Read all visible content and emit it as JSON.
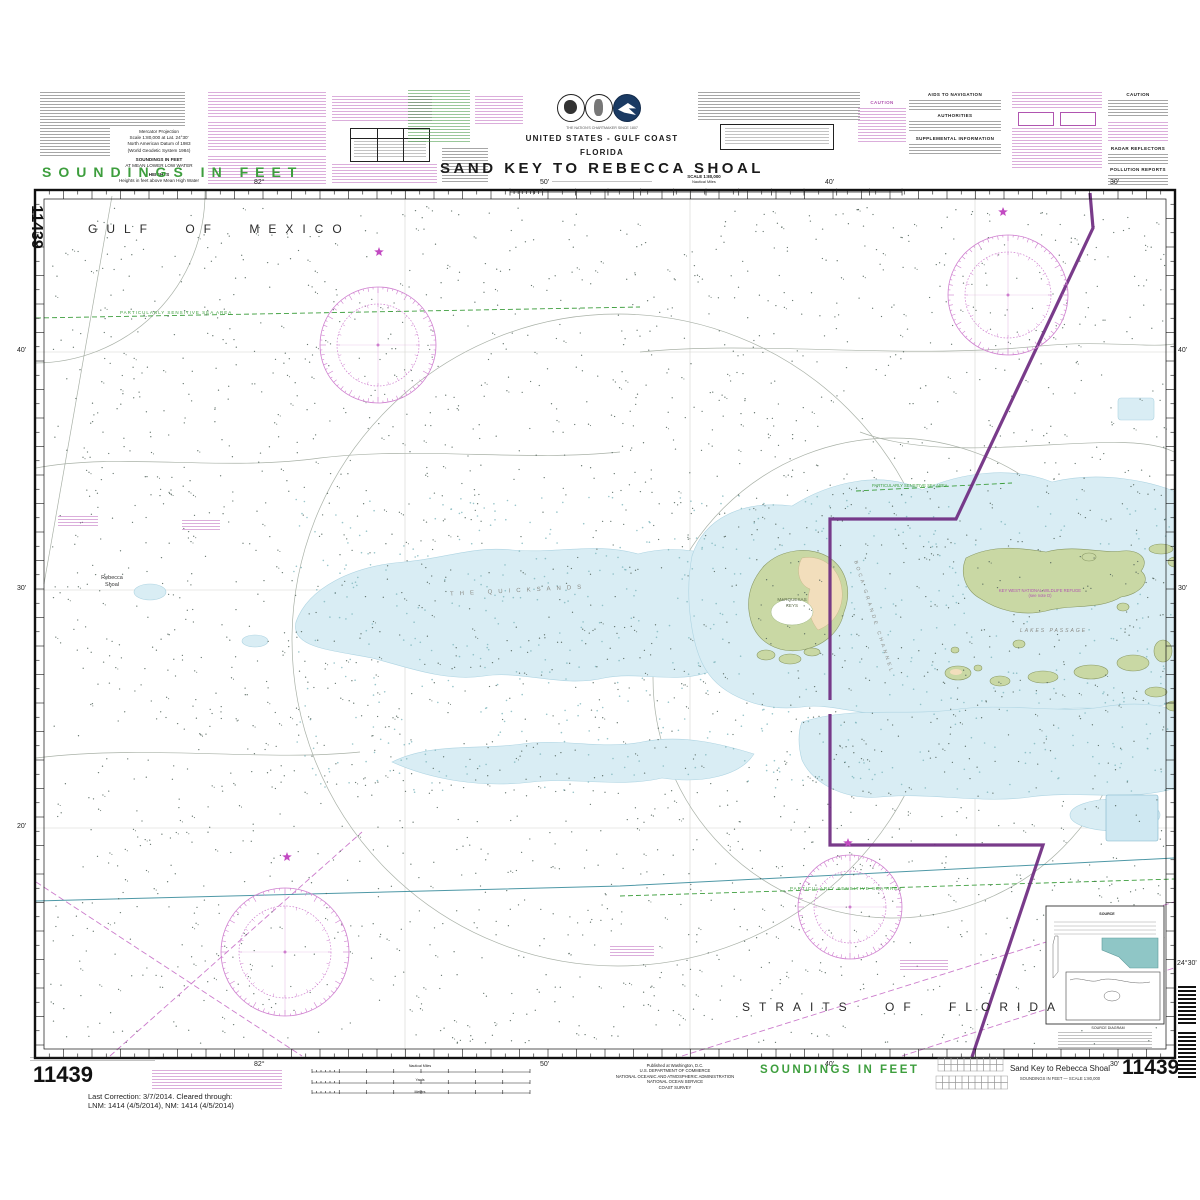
{
  "header": {
    "tagline": "THE NATION'S CHARTMAKER SINCE 1807",
    "region": "UNITED STATES - GULF COAST",
    "state": "FLORIDA",
    "title": "SAND KEY TO REBECCA SHOAL",
    "scale_label": "SCALE 1:80,000",
    "scale_units": "Nautical Miles"
  },
  "projection": {
    "lines": [
      "Mercator Projection",
      "Scale 1:80,000 at Lat. 24°30'",
      "North American Datum of 1983",
      "(World Geodetic System 1984)",
      "SOUNDINGS IN FEET",
      "AT MEAN LOWER LOW WATER",
      "HEIGHTS",
      "Heights in feet above Mean High Water"
    ]
  },
  "notes": {
    "caution": "CAUTION",
    "aids_to_navigation": "AIDS TO NAVIGATION",
    "authorities": "AUTHORITIES",
    "supplemental_information": "SUPPLEMENTAL INFORMATION",
    "radar_reflectors": "RADAR REFLECTORS",
    "pollution_reports": "POLLUTION REPORTS"
  },
  "margin": {
    "soundings_top": "SOUNDINGS IN FEET",
    "soundings_bottom": "SOUNDINGS IN FEET",
    "chart_number": "11439",
    "last_correction_line1": "Last Correction: 3/7/2014.  Cleared through:",
    "last_correction_line2": "LNM: 1414 (4/5/2014), NM: 1414 (4/5/2014)",
    "publisher": [
      "Published at Washington, D.C.",
      "U.S. DEPARTMENT OF COMMERCE",
      "NATIONAL OCEANIC AND ATMOSPHERIC ADMINISTRATION",
      "NATIONAL OCEAN SERVICE",
      "COAST SURVEY"
    ],
    "caption_title": "Sand Key to Rebecca Shoal",
    "caption_sub": "SOUNDINGS IN FEET — SCALE 1:80,000",
    "scalebar_miles": "Nautical Miles",
    "scalebar_yards": "Yards",
    "scalebar_meters": "Meters"
  },
  "map": {
    "sea1": "GULF OF MEXICO",
    "sea2": "STRAITS OF FLORIDA",
    "labels": {
      "rebecca1": "Rebecca",
      "rebecca2": "Shoal",
      "quicksands": "THE QUICKSANDS",
      "boca_grande": "BOCA GRANDE CHANNEL",
      "marquesas1": "MARQUESAS",
      "marquesas2": "KEYS",
      "lakes_passage": "LAKES   PASSAGE",
      "refuge1": "KEY WEST NATIONAL WILDLIFE REFUGE",
      "refuge2": "(see note D)",
      "pssa": "PARTICULARLY SENSITIVE SEA AREA"
    },
    "graticule": {
      "top": [
        "82°",
        "50'",
        "40'",
        "30'"
      ],
      "bottom": [
        "82°",
        "50'",
        "40'",
        "30'"
      ],
      "left": [
        "40'",
        "30'",
        "20'"
      ],
      "right": [
        "40'",
        "30'",
        "24°30'"
      ]
    },
    "source_diagram": {
      "title": "SOURCE",
      "caption": "SOURCE DIAGRAM"
    }
  }
}
